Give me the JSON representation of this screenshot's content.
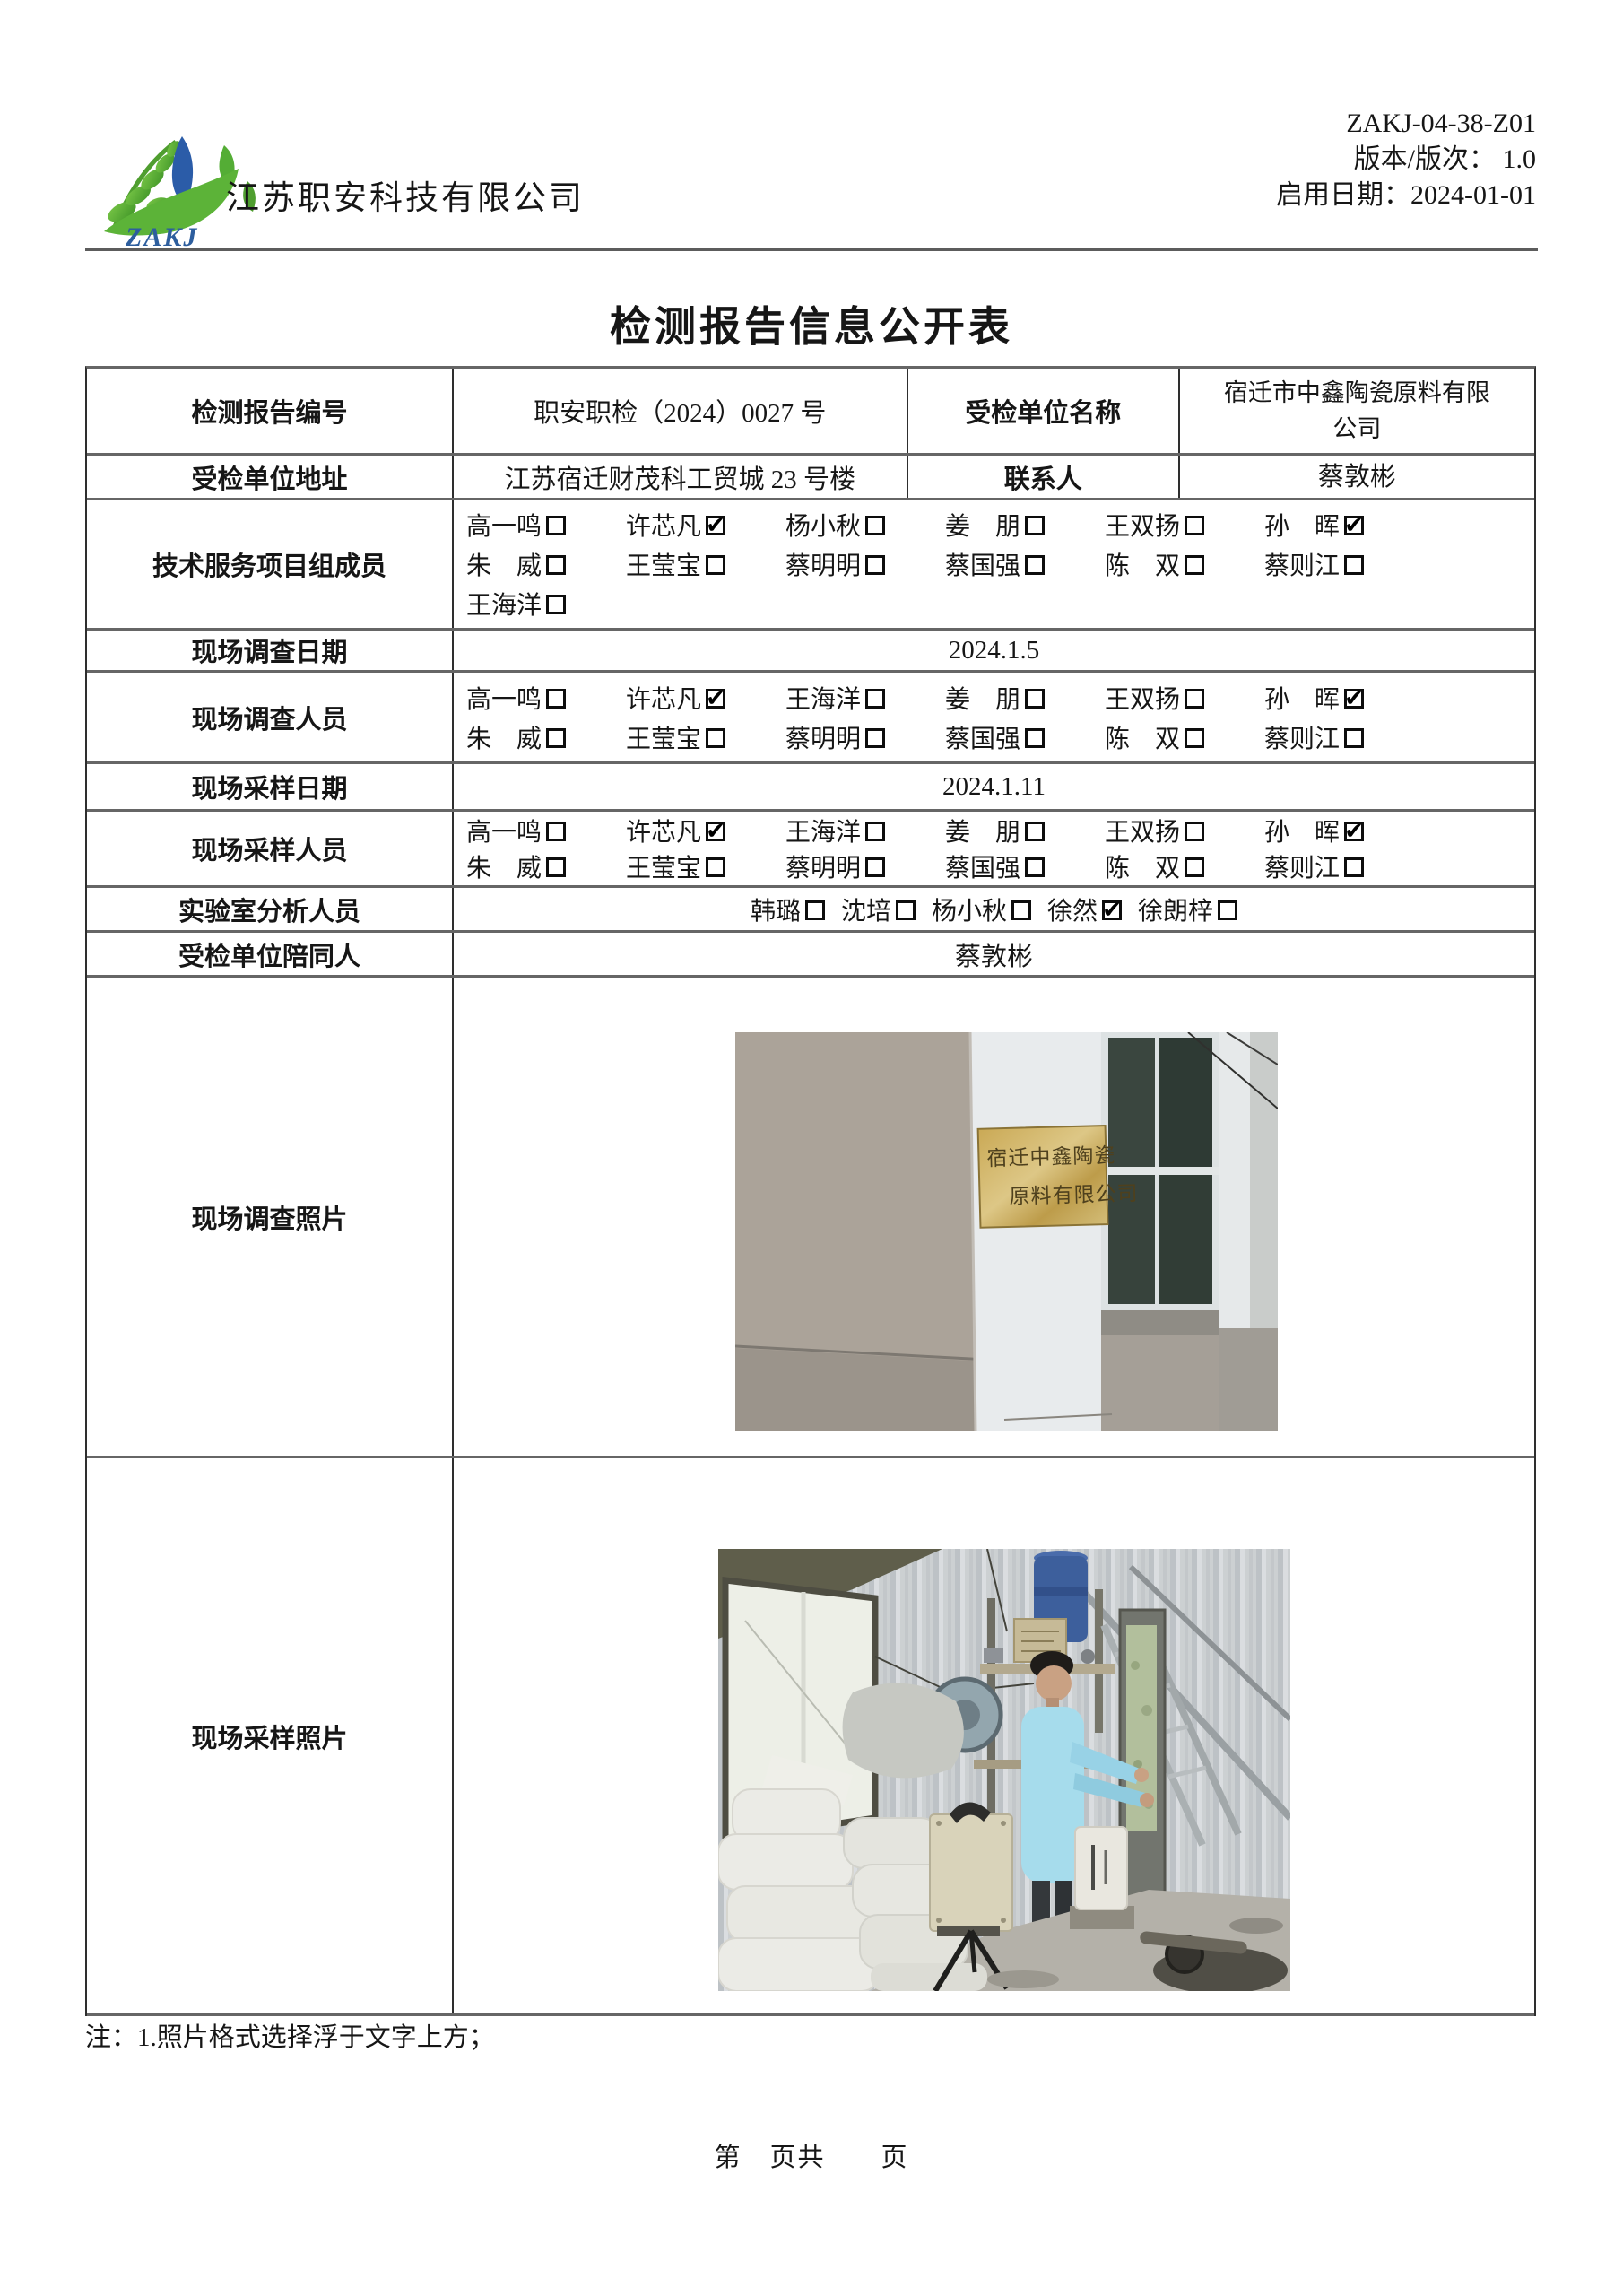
{
  "header": {
    "company_name": "江苏职安科技有限公司",
    "logo_acronym": "ZAKJ",
    "meta_lines": [
      "ZAKJ-04-38-Z01",
      "版本/版次： 1.0",
      "启用日期：2024-01-01"
    ]
  },
  "title": "检测报告信息公开表",
  "info": {
    "report_no_label": "检测报告编号",
    "report_no_value": "职安职检（2024）0027 号",
    "unit_name_label": "受检单位名称",
    "unit_name_value": "宿迁市中鑫陶瓷原料有限公司",
    "unit_addr_label": "受检单位地址",
    "unit_addr_value": "江苏宿迁财茂科工贸城 23 号楼",
    "contact_label": "联系人",
    "contact_value": "蔡敦彬"
  },
  "personnel": {
    "tech": {
      "label": "技术服务项目组成员",
      "lines": [
        [
          {
            "name": "高一鸣",
            "checked": false
          },
          {
            "name": "许芯凡",
            "checked": true
          },
          {
            "name": "杨小秋",
            "checked": false
          },
          {
            "name": "姜　朋",
            "checked": false
          },
          {
            "name": "王双扬",
            "checked": false
          },
          {
            "name": "孙　晖",
            "checked": true
          }
        ],
        [
          {
            "name": "朱　威",
            "checked": false
          },
          {
            "name": "王莹宝",
            "checked": false
          },
          {
            "name": "蔡明明",
            "checked": false
          },
          {
            "name": "蔡国强",
            "checked": false
          },
          {
            "name": "陈　双",
            "checked": false
          },
          {
            "name": "蔡则江",
            "checked": false
          }
        ],
        [
          {
            "name": "王海洋",
            "checked": false
          }
        ]
      ]
    },
    "survey_date": {
      "label": "现场调查日期",
      "value": "2024.1.5"
    },
    "survey_staff": {
      "label": "现场调查人员",
      "lines": [
        [
          {
            "name": "高一鸣",
            "checked": false
          },
          {
            "name": "许芯凡",
            "checked": true
          },
          {
            "name": "王海洋",
            "checked": false
          },
          {
            "name": "姜　朋",
            "checked": false
          },
          {
            "name": "王双扬",
            "checked": false
          },
          {
            "name": "孙　晖",
            "checked": true
          }
        ],
        [
          {
            "name": "朱　威",
            "checked": false
          },
          {
            "name": "王莹宝",
            "checked": false
          },
          {
            "name": "蔡明明",
            "checked": false
          },
          {
            "name": "蔡国强",
            "checked": false
          },
          {
            "name": "陈　双",
            "checked": false
          },
          {
            "name": "蔡则江",
            "checked": false
          }
        ]
      ]
    },
    "sampling_date": {
      "label": "现场采样日期",
      "value": "2024.1.11"
    },
    "sampling_staff": {
      "label": "现场采样人员",
      "lines": [
        [
          {
            "name": "高一鸣",
            "checked": false
          },
          {
            "name": "许芯凡",
            "checked": true
          },
          {
            "name": "王海洋",
            "checked": false
          },
          {
            "name": "姜　朋",
            "checked": false
          },
          {
            "name": "王双扬",
            "checked": false
          },
          {
            "name": "孙　晖",
            "checked": true
          }
        ],
        [
          {
            "name": "朱　威",
            "checked": false
          },
          {
            "name": "王莹宝",
            "checked": false
          },
          {
            "name": "蔡明明",
            "checked": false
          },
          {
            "name": "蔡国强",
            "checked": false
          },
          {
            "name": "陈　双",
            "checked": false
          },
          {
            "name": "蔡则江",
            "checked": false
          }
        ]
      ]
    },
    "lab": {
      "label": "实验室分析人员",
      "lines": [
        [
          {
            "name": "韩璐",
            "checked": false
          },
          {
            "name": "沈培",
            "checked": false
          },
          {
            "name": "杨小秋",
            "checked": false
          },
          {
            "name": "徐然",
            "checked": true
          },
          {
            "name": "徐朗梓",
            "checked": false
          }
        ]
      ]
    },
    "escort": {
      "label": "受检单位陪同人",
      "value": "蔡敦彬"
    }
  },
  "photos": {
    "survey": {
      "label": "现场调查照片",
      "plaque_line1": "宿迁中鑫陶瓷",
      "plaque_line2": "原料有限公司"
    },
    "sampling": {
      "label": "现场采样照片"
    }
  },
  "note": "注：1.照片格式选择浮于文字上方；",
  "pager": "第　页共　　页",
  "colors": {
    "logo_green": "#5cb338",
    "logo_blue": "#2b5ca8",
    "plaque_gold": "#c7ab5e",
    "rule_grey": "#5c5c5c"
  }
}
